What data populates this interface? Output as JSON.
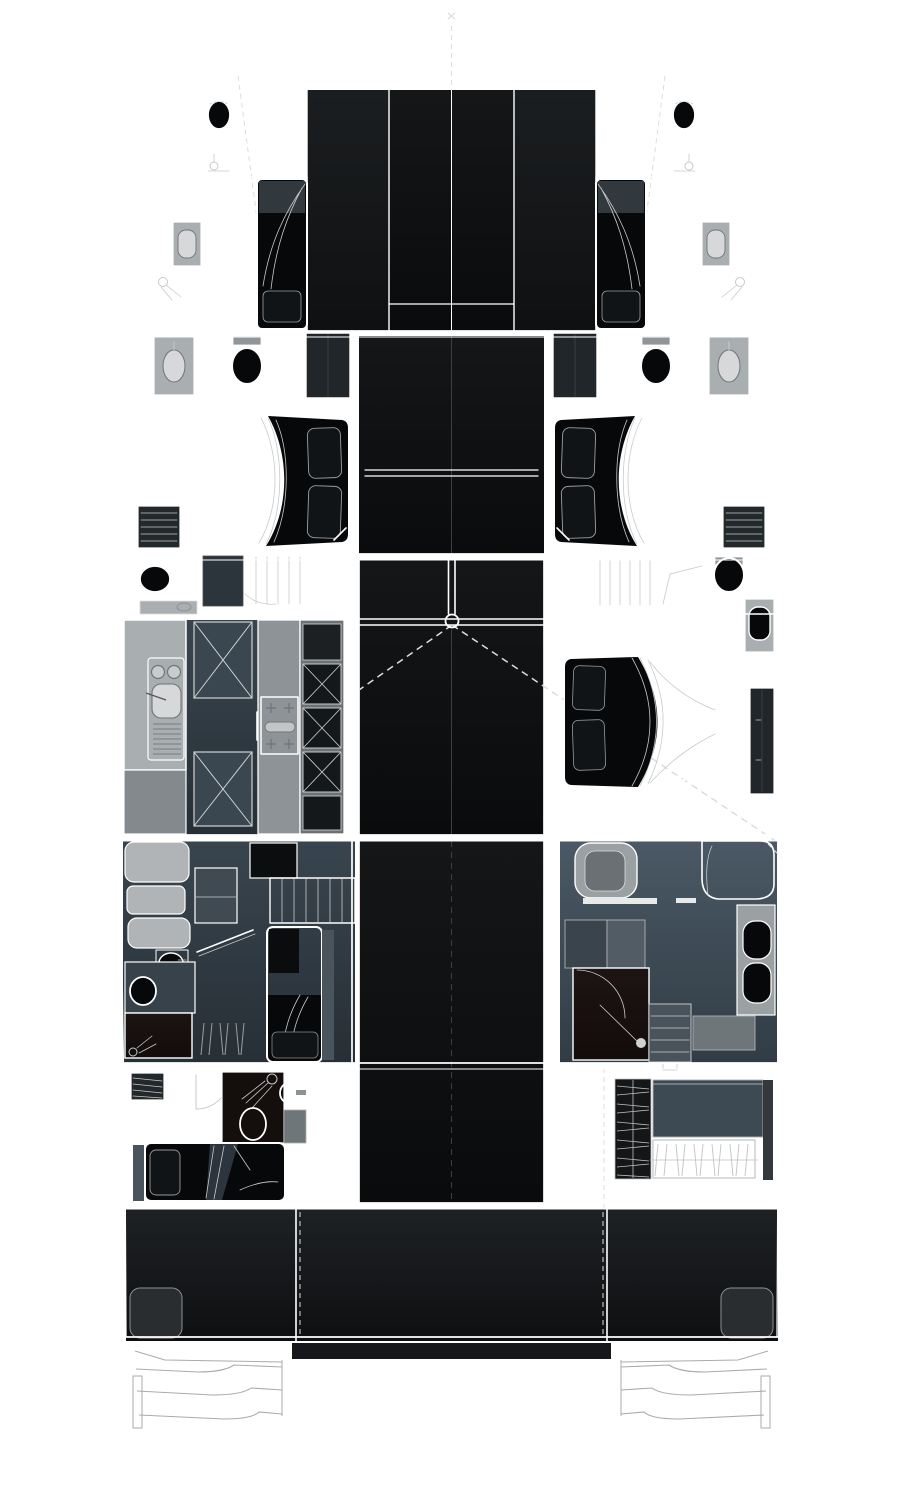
{
  "meta": {
    "title": "Catamaran yacht interior deck plan, top-down layout",
    "view": "top-down",
    "theme": "dark hull with white partition lines"
  },
  "palette": {
    "background": "#ffffff",
    "line_white": "#ffffff",
    "line_soft": "#c7cacb",
    "step_line": "#a8abad",
    "dash_line": "#dcdddd",
    "faint_line": "#3c3f41",
    "hull_deck_top": "#232628",
    "hull_deck_bottom": "#0b0c0d",
    "panel_top": "#1b1e20",
    "panel_bottom": "#0f1012",
    "panel_center_top": "#141618",
    "panel_center_bottom": "#0a0b0c",
    "floor_top": "#4a5965",
    "floor_bottom": "#313c45",
    "floor_dark_top": "#39454e",
    "floor_dark_bottom": "#272f36",
    "brown_top": "#1d1413",
    "brown_bottom": "#120c0b",
    "bed_black": "#07080a",
    "pillow_dark": "#111417",
    "counter_light": "#a9aeb0",
    "basin_light": "#d6d8d9",
    "fixture_mid": "#8f9598",
    "cabinet_dark": "#21262b",
    "cabinet_mid": "#6b7174",
    "sofa_light": "#b0b4b6",
    "vent_dark": "#23282b",
    "hatch_blue": "#3a4650",
    "foot_light": "#9ba2a5",
    "foot_dark": "#22262a",
    "shower_light": "#bcc0c1",
    "shower_dark": "#838a8d",
    "stairs_top": "#4c5862",
    "stairs_bottom": "#2b343b",
    "transom_top": "#45484b",
    "transom_bottom": "#2e3133",
    "cockpit_top": "#1e2124",
    "cockpit_bottom": "#0e0f11"
  },
  "rooms": {
    "hull": "Catamaran hull and deck outline",
    "bowsprit": "Bowsprit",
    "forward_beam": "Forward crossbeam",
    "foredeck": "Foredeck panels",
    "port_bow_head": "Port bow head (WC)",
    "port_bow_cabin": "Port bow cabin with single berth",
    "starboard_bow_head": "Starboard bow head (WC)",
    "starboard_bow_cabin": "Starboard bow cabin with single berth",
    "port_vip_suite": "Port forward double cabin with bathroom",
    "starboard_vip_suite": "Starboard forward double cabin with bathroom",
    "salon": "Salon / deckhouse",
    "galley": "Port galley with sink, stove and cold storage",
    "galley_head": "Port mid bathroom",
    "owner_bathroom": "Starboard owner bathroom with shower",
    "owner_cabin": "Starboard owner double cabin",
    "mast_point": "Mast step and rigging lines",
    "port_aft_cabin": "Port aft cabin with lounge, desk and berth",
    "starboard_aft_bathroom": "Starboard aft bathroom with double vanity",
    "port_aft_guest_cabin": "Port aft guest cabin with shower and WC",
    "starboard_technical_room": "Starboard technical / crew room",
    "aft_cockpit": "Aft cockpit",
    "port_swim_platform": "Port transom steps",
    "starboard_swim_platform": "Starboard transom steps"
  }
}
